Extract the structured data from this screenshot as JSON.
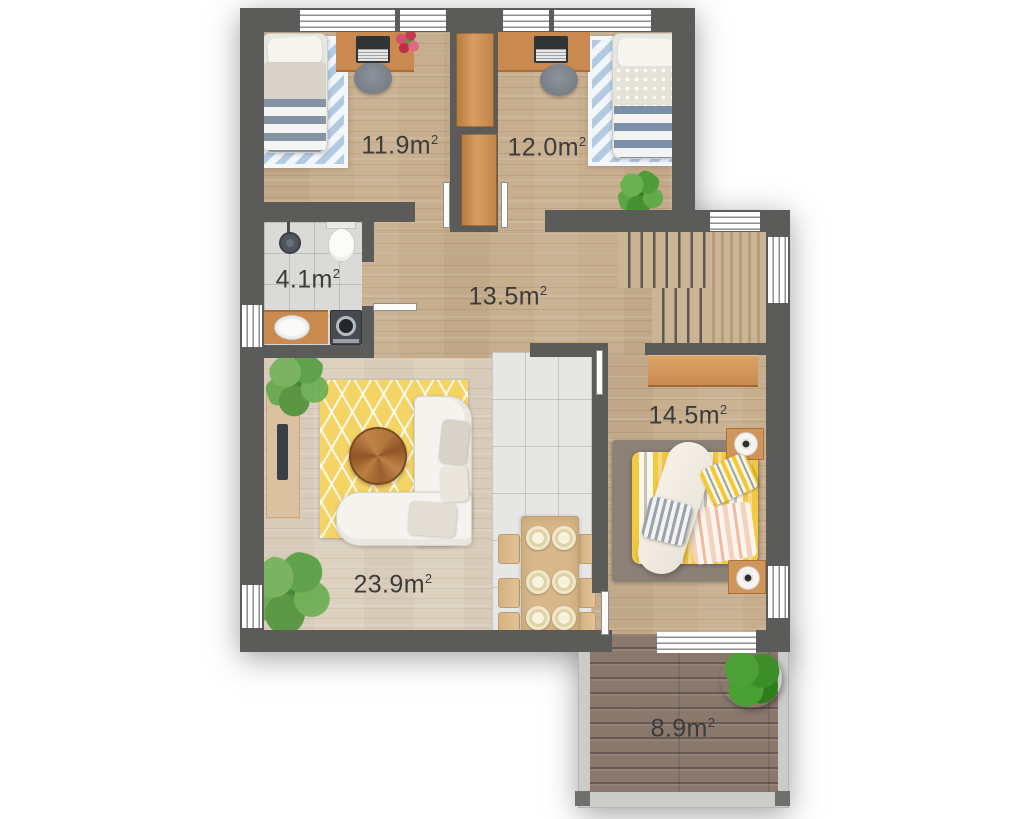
{
  "canvas": {
    "width": 1024,
    "height": 819,
    "background": "#ffffff"
  },
  "rooms": [
    {
      "id": "bedroom-top-left",
      "area_value": "11.9m",
      "area_sup": "2",
      "furniture": [
        "single-bed",
        "chevron-rug",
        "desk",
        "laptop",
        "desk-chair",
        "flower-bouquet",
        "built-in-wardrobe"
      ]
    },
    {
      "id": "bedroom-top-right",
      "area_value": "12.0m",
      "area_sup": "2",
      "furniture": [
        "desk",
        "laptop",
        "desk-chair",
        "single-bed",
        "chevron-rug",
        "potted-plant",
        "built-in-wardrobe"
      ]
    },
    {
      "id": "bathroom",
      "area_value": "4.1m",
      "area_sup": "2",
      "furniture": [
        "shower",
        "toilet",
        "sink-counter",
        "washing-machine"
      ]
    },
    {
      "id": "hallway",
      "area_value": "13.5m",
      "area_sup": "2",
      "furniture": [
        "staircase"
      ]
    },
    {
      "id": "bedroom-right",
      "area_value": "14.5m",
      "area_sup": "2",
      "furniture": [
        "wardrobe",
        "double-bed",
        "area-rug",
        "nightstand-with-lamp",
        "nightstand-with-lamp"
      ]
    },
    {
      "id": "living-room",
      "area_value": "23.9m",
      "area_sup": "2",
      "furniture": [
        "tv-sideboard",
        "potted-plant",
        "potted-plant",
        "patterned-rug",
        "round-coffee-table",
        "corner-sofa",
        "dining-table",
        "dining-chairs",
        "place-settings"
      ]
    },
    {
      "id": "terrace",
      "area_value": "8.9m",
      "area_sup": "2",
      "furniture": [
        "bush",
        "wood-decking"
      ]
    }
  ],
  "colors": {
    "wall": "#5b5b59",
    "wood_floor": "#c7ae8e",
    "living_floor": "#ddd1c0",
    "kitchen_tile": "#e6e6e4",
    "bath_tile": "#dadad8",
    "accent_wood": "#c9894f",
    "wardrobe_wood": "#d0955a",
    "terrace_deck": "#8a786d",
    "rug_blue": "#b2cbe2",
    "rug_yellow": "#f5d466",
    "bed_yellow": "#f3c93f",
    "rug_gray": "#8b8177",
    "stair_wood": "#cbb493",
    "window_line": "#8e8e8c",
    "label": "#3c3c3a"
  }
}
